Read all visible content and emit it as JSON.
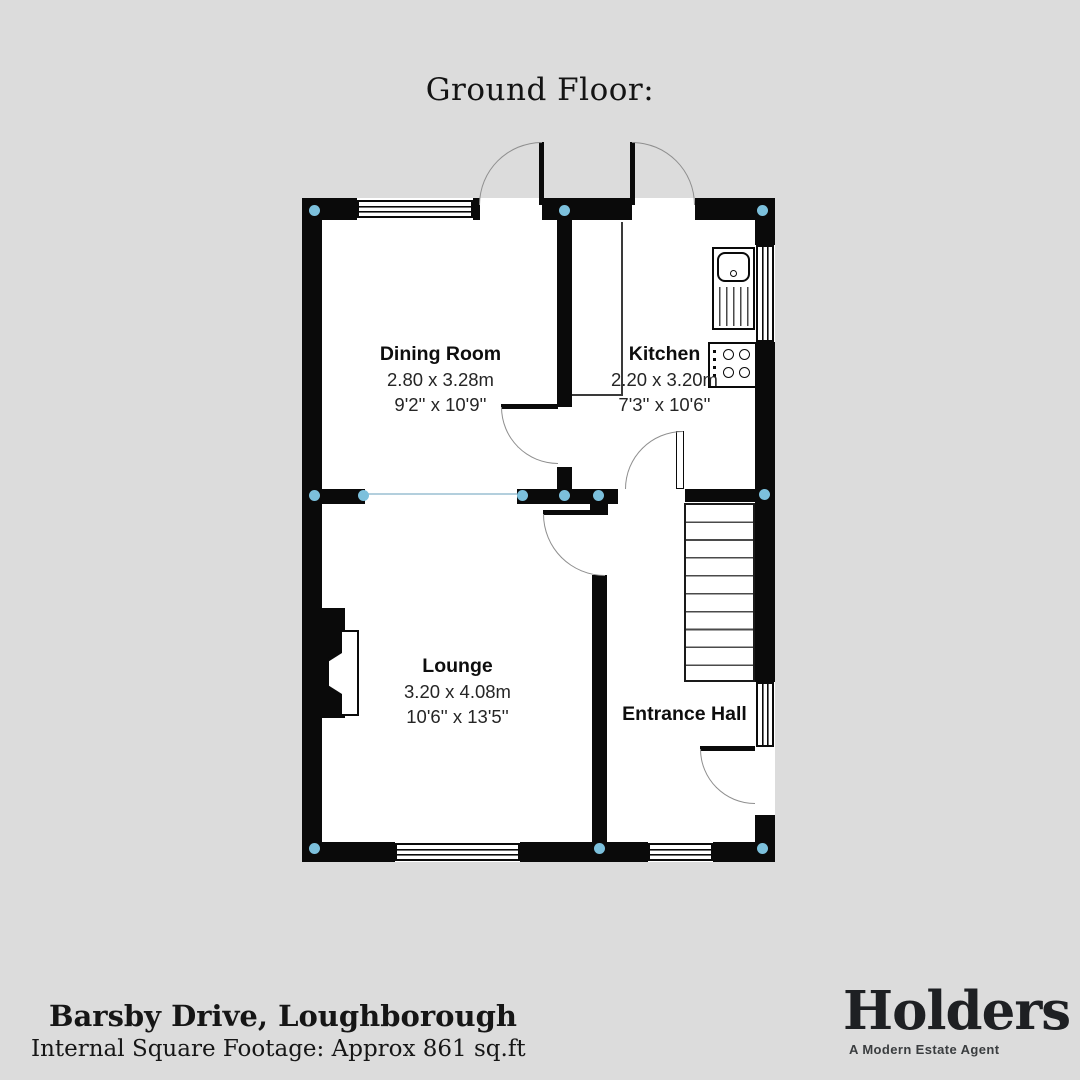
{
  "title": "Ground Floor:",
  "rooms": [
    {
      "name": "Dining Room",
      "metric": "2.80 x 3.28m",
      "imperial": "9'2'' x 10'9''"
    },
    {
      "name": "Kitchen",
      "metric": "2.20 x 3.20m",
      "imperial": "7'3'' x 10'6''"
    },
    {
      "name": "Lounge",
      "metric": "3.20 x 4.08m",
      "imperial": "10'6'' x 13'5''"
    },
    {
      "name": "Entrance Hall",
      "metric": "",
      "imperial": ""
    }
  ],
  "footer": {
    "address": "Barsby Drive, Loughborough",
    "square_footage": "Internal Square Footage: Approx 861 sq.ft"
  },
  "logo": {
    "brand": "Holders",
    "tagline": "A Modern Estate Agent"
  },
  "colors": {
    "background": "#dcdcdc",
    "wall": "#0a0a0a",
    "room_fill": "#ffffff",
    "junction_dot": "#7cc0dc",
    "open_plan_line": "#b3cfdd",
    "door_arc": "#8f8f8f"
  }
}
